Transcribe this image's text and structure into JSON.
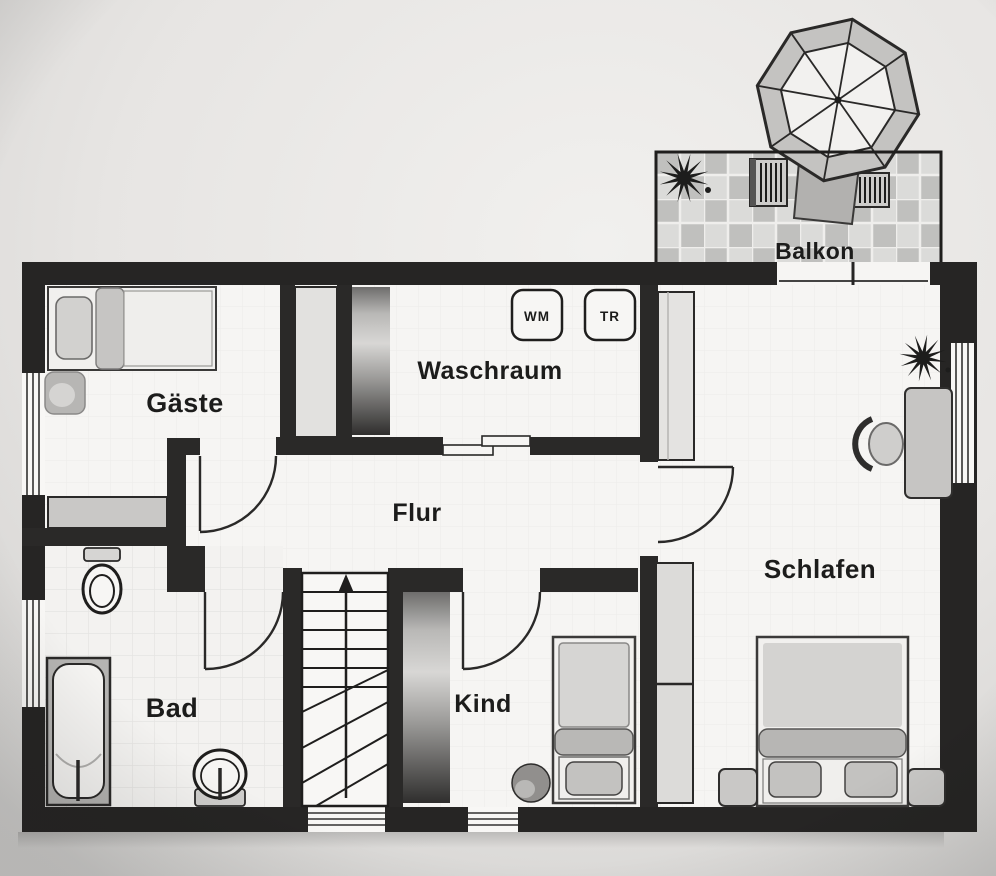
{
  "colors": {
    "paper": "#e7e5e3",
    "wall": "#262524",
    "floor": "#f6f5f3",
    "furniture_light": "#e2e1df",
    "furniture_mid": "#c2c1bf",
    "furniture_dark": "#8f8e8c",
    "tile_light": "#dbdbd9",
    "tile_mid": "#c0c0be",
    "line": "#2a2928",
    "text": "#1c1c1b"
  },
  "rooms": {
    "gaeste": "Gäste",
    "waschraum": "Waschraum",
    "flur": "Flur",
    "bad": "Bad",
    "kind": "Kind",
    "schlafen": "Schlafen",
    "balkon": "Balkon"
  },
  "appliances": {
    "washing_machine": "WM",
    "dryer": "TR"
  },
  "fixtures": [
    "single-bed",
    "double-bed",
    "child-bed",
    "nightstand",
    "dresser",
    "built-in-closet",
    "shaft",
    "wardrobe",
    "tall-cabinet",
    "toilet",
    "bathtub",
    "washbasin",
    "staircase-up-arrow",
    "desk",
    "desk-chair",
    "stool",
    "plant",
    "parasol",
    "parasol-stand",
    "sun-lounger",
    "balcony-tiles",
    "window",
    "door-swing",
    "sliding-door"
  ]
}
